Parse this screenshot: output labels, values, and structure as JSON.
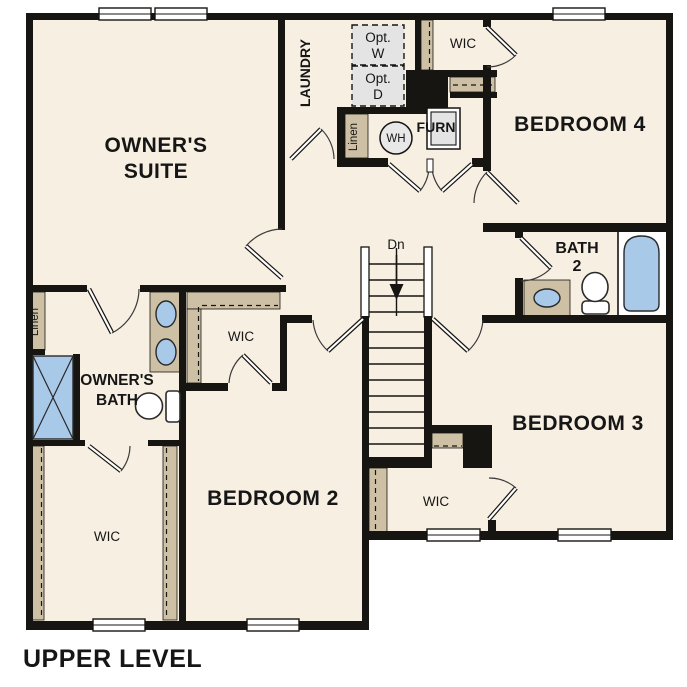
{
  "title": "UPPER LEVEL",
  "colors": {
    "wall": "#171512",
    "floor": "#f7efe2",
    "closet": "#cdc0a5",
    "fixture": "#a9c9e9",
    "appliance": "#e4e4e4"
  },
  "rooms": {
    "owners_suite": {
      "line1": "OWNER'S",
      "line2": "SUITE"
    },
    "laundry": {
      "label": "LAUNDRY"
    },
    "bedroom2": {
      "label": "BEDROOM 2"
    },
    "bedroom3": {
      "label": "BEDROOM 3"
    },
    "bedroom4": {
      "label": "BEDROOM 4"
    },
    "bath2": {
      "line1": "BATH",
      "line2": "2"
    },
    "owners_bath": {
      "line1": "OWNER'S",
      "line2": "BATH"
    },
    "wic": {
      "label": "WIC"
    }
  },
  "fixtures": {
    "linen": "Linen",
    "opt_washer": {
      "line1": "Opt.",
      "line2": "W"
    },
    "opt_dryer": {
      "line1": "Opt.",
      "line2": "D"
    },
    "water_heater": "WH",
    "furnace": "FURN",
    "stairs_down": "Dn"
  }
}
